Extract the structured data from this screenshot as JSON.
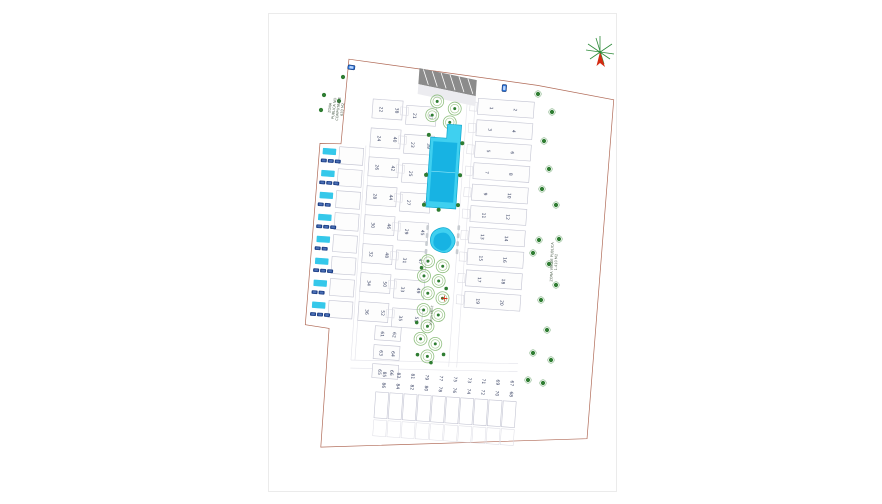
{
  "page": {
    "background": "#ffffff",
    "sheet_border": "#ebebeb"
  },
  "colors": {
    "boundary": "#b06a57",
    "building_stroke": "#c3c4d2",
    "pool_outer": "#3fd0f0",
    "pool_inner": "#17b3e3",
    "villa_pool": "#35c8ea",
    "car_navy": "#1d3f86",
    "car_blue_label": "#2b74d8",
    "tree_green": "#2f7d32",
    "cluster_green": "#8fbf7f",
    "road_dark": "#8b8b8b",
    "compass_green": "#2e8b3a",
    "compass_red": "#d42a12",
    "number_color": "#3d4666"
  },
  "zones": {
    "left": {
      "lines": [
        "ZONA",
        "PUBLICA NO",
        "COMPUTABLE",
        "633 M2"
      ]
    },
    "right": {
      "lines": [
        "ZONA VERDE PUBLICA",
        "1.410 M2"
      ]
    },
    "center": {
      "label": "ZONA VERDE"
    }
  },
  "plots": {
    "right_strip": {
      "west": [
        "1",
        "3",
        "5",
        "7",
        "9",
        "11",
        "13",
        "15",
        "17",
        "19"
      ],
      "east": [
        "2",
        "4",
        "6",
        "8",
        "10",
        "12",
        "14",
        "16",
        "18",
        "20"
      ]
    },
    "mid_strip_a": {
      "west": [
        "22",
        "24",
        "26",
        "28",
        "30",
        "32",
        "34",
        "36"
      ],
      "east": [
        "38",
        "40",
        "42",
        "44",
        "46",
        "48",
        "50",
        "52"
      ]
    },
    "mid_strip_b": {
      "west": [
        "21",
        "23",
        "25",
        "27",
        "29",
        "31",
        "33",
        "35"
      ],
      "east": [
        "37",
        "39",
        "41",
        "43",
        "45",
        "47",
        "49",
        "51"
      ]
    },
    "left_wing": {
      "numbers": [
        "60",
        "59",
        "58",
        "57",
        "56",
        "55",
        "54",
        "53"
      ],
      "cars_per_villa": [
        3,
        3,
        2,
        3,
        2,
        3,
        2,
        3
      ]
    },
    "lower_left_pairs": [
      [
        "61",
        "62"
      ],
      [
        "63",
        "64"
      ],
      [
        "65",
        "66"
      ]
    ],
    "bottom_row_pairs": [
      [
        "85",
        "86"
      ],
      [
        "83",
        "84"
      ],
      [
        "81",
        "82"
      ],
      [
        "79",
        "80"
      ],
      [
        "77",
        "78"
      ],
      [
        "75",
        "76"
      ],
      [
        "73",
        "74"
      ],
      [
        "71",
        "72"
      ],
      [
        "69",
        "70"
      ],
      [
        "67",
        "68"
      ]
    ]
  },
  "park": {
    "tree_clusters_top": [
      [
        122,
        36
      ],
      [
        140,
        42
      ],
      [
        118,
        50
      ],
      [
        136,
        56
      ]
    ],
    "tree_clusters_lower": [
      [
        124,
        196
      ],
      [
        139,
        200
      ],
      [
        121,
        211
      ],
      [
        136,
        215
      ],
      [
        126,
        228
      ],
      [
        141,
        232
      ],
      [
        123,
        245
      ],
      [
        138,
        249
      ],
      [
        128,
        261
      ],
      [
        122,
        274
      ],
      [
        137,
        278
      ],
      [
        130,
        291
      ]
    ],
    "tree_dots_park": [
      [
        118,
        203
      ],
      [
        144,
        222
      ],
      [
        117,
        258
      ],
      [
        134,
        297
      ],
      [
        146,
        288
      ],
      [
        120,
        290
      ]
    ],
    "pool_palm_dots": [
      [
        116,
        70
      ],
      [
        150,
        76
      ],
      [
        116,
        110
      ],
      [
        150,
        108
      ],
      [
        116,
        140
      ],
      [
        150,
        138
      ],
      [
        131,
        144
      ]
    ]
  },
  "green_zones": {
    "trees_right": [
      [
        538,
        94
      ],
      [
        552,
        112
      ],
      [
        544,
        141
      ],
      [
        549,
        169
      ],
      [
        542,
        189
      ],
      [
        556,
        205
      ],
      [
        539,
        240
      ],
      [
        559,
        239
      ],
      [
        533,
        253
      ],
      [
        549,
        264
      ],
      [
        556,
        285
      ],
      [
        541,
        300
      ],
      [
        547,
        330
      ],
      [
        533,
        353
      ],
      [
        551,
        360
      ],
      [
        543,
        383
      ],
      [
        528,
        380
      ]
    ],
    "trees_topleft": [
      [
        343,
        77
      ],
      [
        324,
        95
      ],
      [
        321,
        110
      ],
      [
        339,
        101
      ]
    ]
  },
  "icons": {
    "compass": "north-star-with-red-arrow",
    "tree": "green-dot-tree",
    "tree_cluster": "sketched-canopy-circle",
    "car": "navy-parked-car",
    "car_label": "blue-car-marker",
    "lounger": "gray-sun-lounger"
  }
}
